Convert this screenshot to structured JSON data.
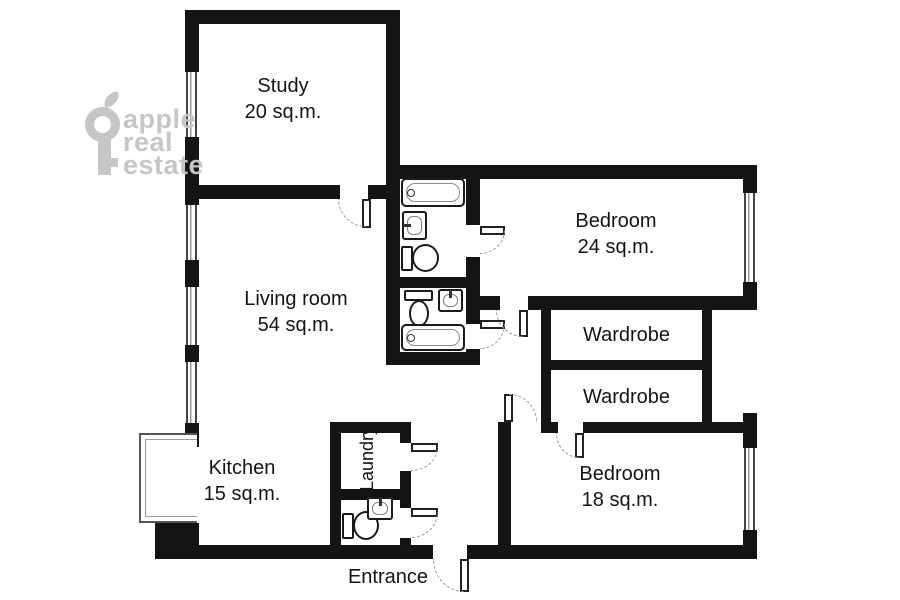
{
  "brand": {
    "icon": "key-icon",
    "lines": [
      "apple",
      "real",
      "estate"
    ],
    "color": "#c6c6c6"
  },
  "rooms": [
    {
      "name": "Study",
      "area": "20 sq.m."
    },
    {
      "name": "Living room",
      "area": "54 sq.m."
    },
    {
      "name": "Bedroom",
      "area": "24 sq.m."
    },
    {
      "name": "Wardrobe"
    },
    {
      "name": "Wardrobe"
    },
    {
      "name": "Bedroom",
      "area": "18 sq.m."
    },
    {
      "name": "Kitchen",
      "area": "15 sq.m."
    },
    {
      "name": "Laundry"
    }
  ],
  "entrance_label": "Entrance",
  "fixtures": [
    {
      "type": "bathtub",
      "location": "bathroom-top"
    },
    {
      "type": "sink",
      "location": "bathroom-top"
    },
    {
      "type": "toilet",
      "location": "bathroom-top"
    },
    {
      "type": "toilet",
      "location": "bathroom-bottom"
    },
    {
      "type": "sink",
      "location": "bathroom-bottom"
    },
    {
      "type": "bathtub",
      "location": "bathroom-bottom"
    },
    {
      "type": "toilet",
      "location": "wc-near-entrance"
    },
    {
      "type": "sink",
      "location": "wc-near-entrance"
    }
  ],
  "colors": {
    "wall": "#141414",
    "background": "#ffffff",
    "door_arc": "#9a9a9a",
    "watermark": "#c6c6c6",
    "text": "#141414"
  }
}
